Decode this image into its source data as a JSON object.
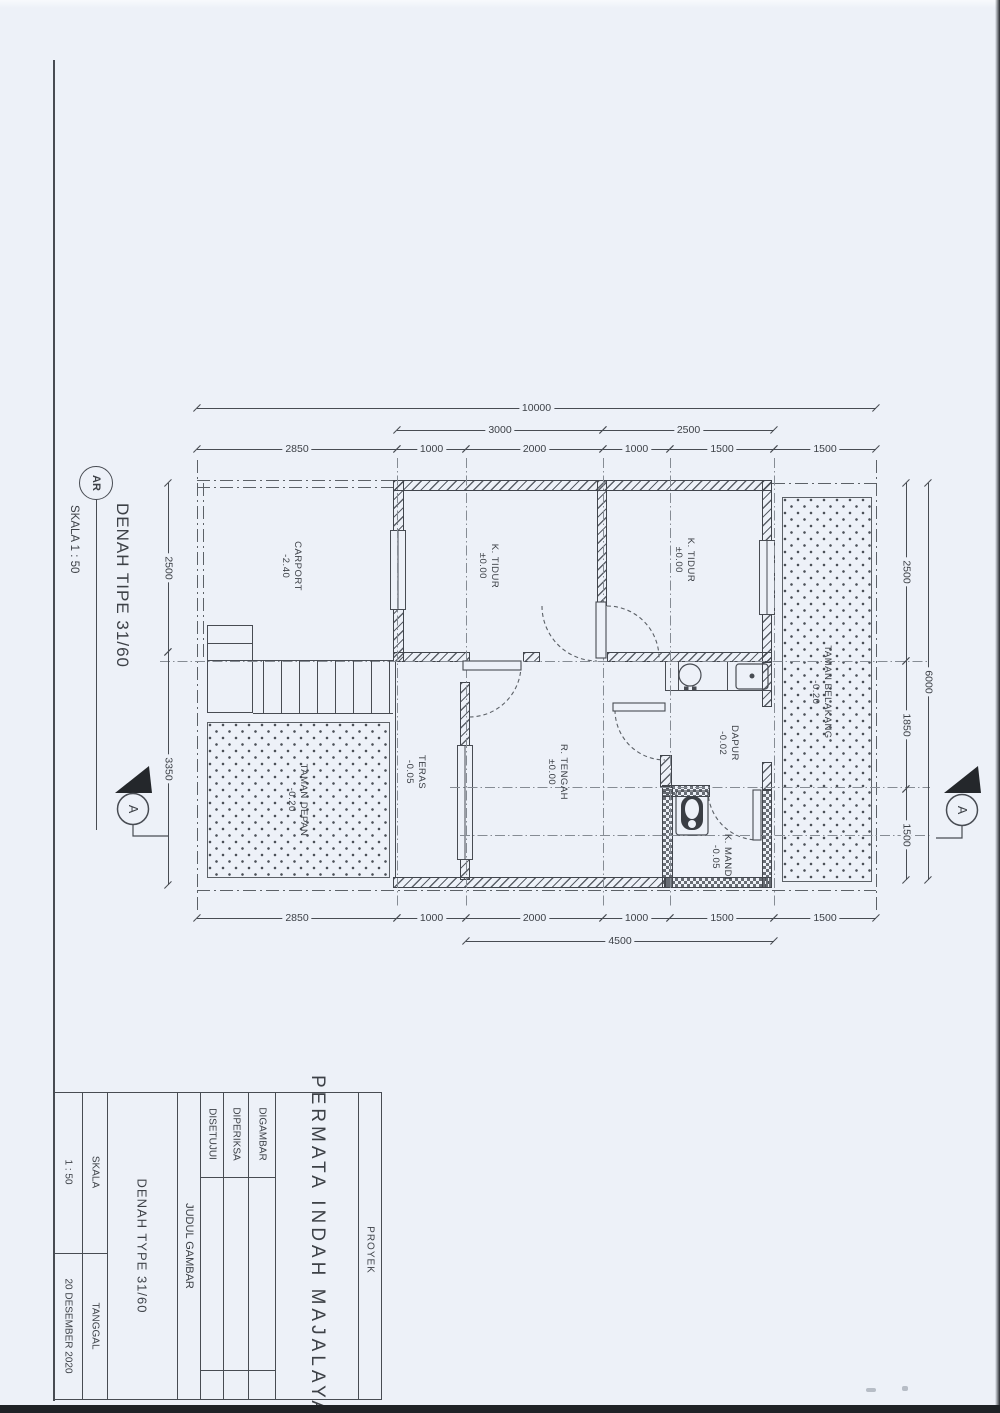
{
  "drawing_title": {
    "code": "AR",
    "title": "DENAH TIPE 31/60",
    "scale": "SKALA 1 : 50"
  },
  "section_markers": [
    {
      "label": "A"
    },
    {
      "label": "A"
    }
  ],
  "plan": {
    "rooms": [
      {
        "name": "CARPORT",
        "level": "-2.40",
        "x": 291,
        "y": 566
      },
      {
        "name": "K. TIDUR",
        "level": "±0.00",
        "x": 488,
        "y": 566
      },
      {
        "name": "K. TIDUR",
        "level": "±0.00",
        "x": 684,
        "y": 560
      },
      {
        "name": "TAMAN BELAKANG",
        "level": "-0.20",
        "x": 821,
        "y": 692
      },
      {
        "name": "TERAS",
        "level": "-0.05",
        "x": 415,
        "y": 772
      },
      {
        "name": "R. TENGAH",
        "level": "±0.00",
        "x": 557,
        "y": 772
      },
      {
        "name": "DAPUR",
        "level": "-0.02",
        "x": 728,
        "y": 743
      },
      {
        "name": "K. MANDI",
        "level": "-0.05",
        "x": 721,
        "y": 857
      },
      {
        "name": "TAMAN DEPAN",
        "level": "-0.20",
        "x": 297,
        "y": 800
      }
    ],
    "h_dims": [
      {
        "y": 408,
        "x1": 197,
        "x2": 876,
        "label": "10000"
      },
      {
        "y": 430,
        "x1": 397,
        "x2": 603,
        "label": "3000"
      },
      {
        "y": 430,
        "x1": 603,
        "x2": 774,
        "label": "2500"
      },
      {
        "y": 449,
        "x1": 197,
        "x2": 397,
        "label": "2850"
      },
      {
        "y": 449,
        "x1": 397,
        "x2": 466,
        "label": "1000"
      },
      {
        "y": 449,
        "x1": 466,
        "x2": 603,
        "label": "2000"
      },
      {
        "y": 449,
        "x1": 603,
        "x2": 670,
        "label": "1000"
      },
      {
        "y": 449,
        "x1": 670,
        "x2": 774,
        "label": "1500"
      },
      {
        "y": 449,
        "x1": 774,
        "x2": 876,
        "label": "1500"
      },
      {
        "y": 918,
        "x1": 197,
        "x2": 397,
        "label": "2850"
      },
      {
        "y": 918,
        "x1": 397,
        "x2": 466,
        "label": "1000"
      },
      {
        "y": 918,
        "x1": 466,
        "x2": 603,
        "label": "2000"
      },
      {
        "y": 918,
        "x1": 603,
        "x2": 670,
        "label": "1000"
      },
      {
        "y": 918,
        "x1": 670,
        "x2": 774,
        "label": "1500"
      },
      {
        "y": 918,
        "x1": 774,
        "x2": 876,
        "label": "1500"
      },
      {
        "y": 941,
        "x1": 466,
        "x2": 774,
        "label": "4500"
      }
    ],
    "v_dims": [
      {
        "x": 168,
        "y1": 483,
        "y2": 652,
        "label": "2500"
      },
      {
        "x": 168,
        "y1": 652,
        "y2": 885,
        "label": "3350"
      },
      {
        "x": 906,
        "y1": 483,
        "y2": 661,
        "label": "2500"
      },
      {
        "x": 906,
        "y1": 661,
        "y2": 789,
        "label": "1850"
      },
      {
        "x": 906,
        "y1": 789,
        "y2": 880,
        "label": "1500"
      },
      {
        "x": 928,
        "y1": 483,
        "y2": 880,
        "label": "6000"
      }
    ]
  },
  "title_block": {
    "proyek_label": "PROYEK",
    "project_name": "PERMATA INDAH MAJALAYA",
    "digambar_label": "DIGAMBAR",
    "diperiksa_label": "DIPERIKSA",
    "disetujui_label": "DISETUJUI",
    "judul_gambar_label": "JUDUL GAMBAR",
    "drawing_name": "DENAH TYPE 31/60",
    "skala_label": "SKALA",
    "skala_value": "1 : 50",
    "tanggal_label": "TANGGAL",
    "tanggal_value": "20 DESEMBER 2020"
  }
}
